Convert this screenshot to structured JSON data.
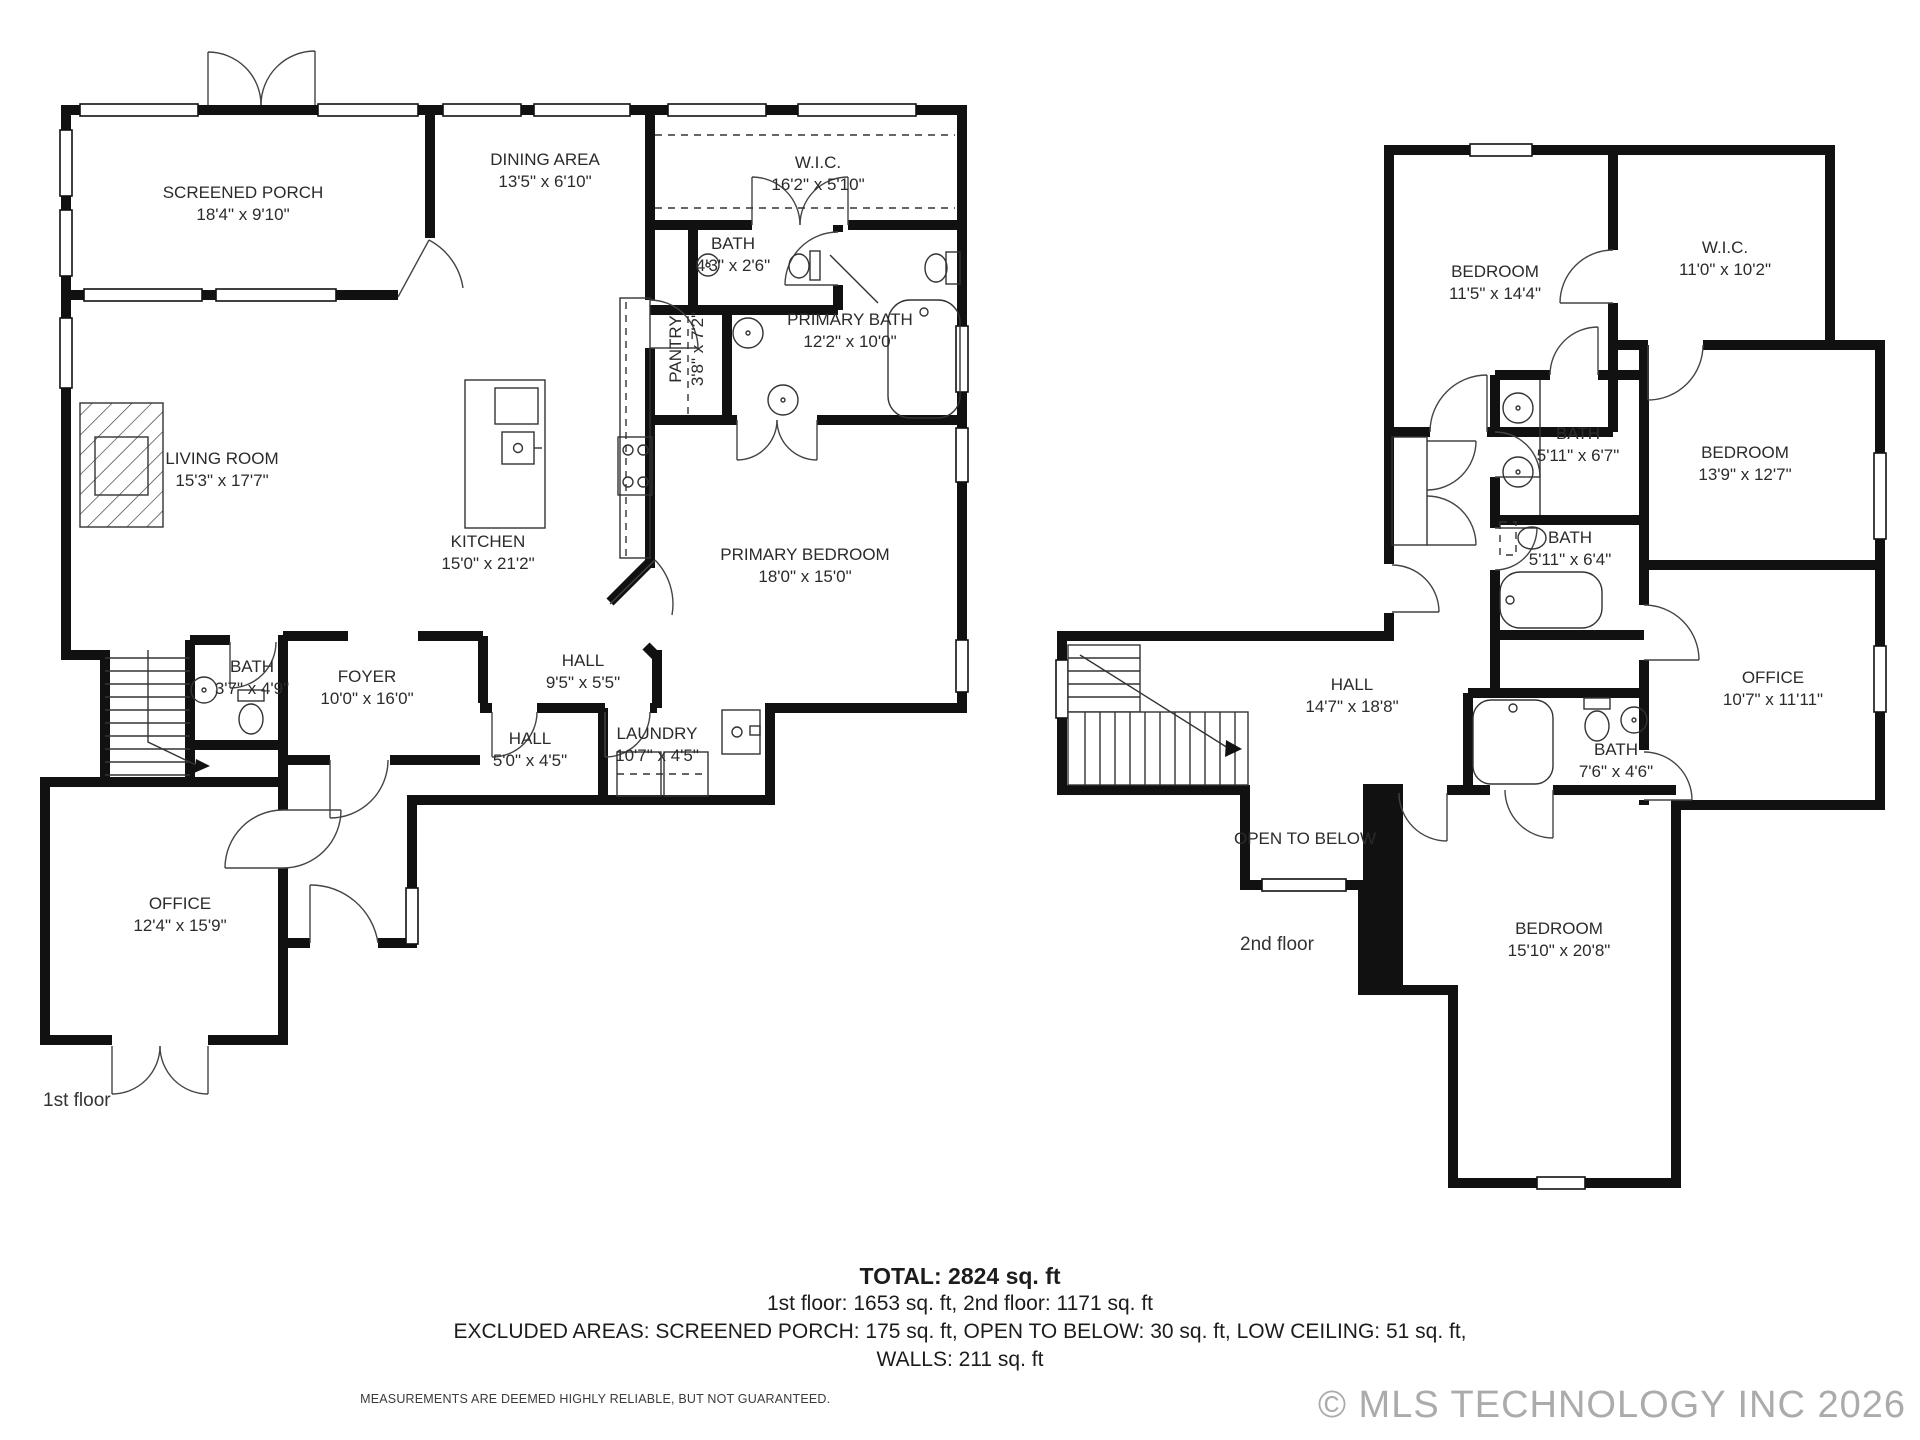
{
  "floor1": {
    "caption": "1st floor",
    "rooms": {
      "screened_porch": {
        "name": "SCREENED PORCH",
        "dims": "18'4\" x 9'10\""
      },
      "dining": {
        "name": "DINING AREA",
        "dims": "13'5\" x 6'10\""
      },
      "wic": {
        "name": "W.I.C.",
        "dims": "16'2\" x 5'10\""
      },
      "bath_small": {
        "name": "BATH",
        "dims": "4'3\" x 2'6\""
      },
      "pantry": {
        "name": "PANTRY",
        "dims": "3'8\" x 7'2\""
      },
      "primary_bath": {
        "name": "PRIMARY BATH",
        "dims": "12'2\" x 10'0\""
      },
      "living": {
        "name": "LIVING ROOM",
        "dims": "15'3\" x 17'7\""
      },
      "kitchen": {
        "name": "KITCHEN",
        "dims": "15'0\" x 21'2\""
      },
      "primary_bedroom": {
        "name": "PRIMARY BEDROOM",
        "dims": "18'0\" x 15'0\""
      },
      "hall_a": {
        "name": "HALL",
        "dims": "9'5\" x 5'5\""
      },
      "foyer": {
        "name": "FOYER",
        "dims": "10'0\" x 16'0\""
      },
      "bath": {
        "name": "BATH",
        "dims": "3'7\" x 4'9\""
      },
      "hall_b": {
        "name": "HALL",
        "dims": "5'0\" x 4'5\""
      },
      "laundry": {
        "name": "LAUNDRY",
        "dims": "10'7\" x 4'5\""
      },
      "office": {
        "name": "OFFICE",
        "dims": "12'4\" x 15'9\""
      }
    }
  },
  "floor2": {
    "caption": "2nd floor",
    "rooms": {
      "bedroom_a": {
        "name": "BEDROOM",
        "dims": "11'5\" x 14'4\""
      },
      "wic": {
        "name": "W.I.C.",
        "dims": "11'0\" x 10'2\""
      },
      "bath_a": {
        "name": "BATH",
        "dims": "5'11\" x 6'7\""
      },
      "bedroom_b": {
        "name": "BEDROOM",
        "dims": "13'9\" x 12'7\""
      },
      "bath_b": {
        "name": "BATH",
        "dims": "5'11\" x 6'4\""
      },
      "office": {
        "name": "OFFICE",
        "dims": "10'7\" x 11'11\""
      },
      "hall": {
        "name": "HALL",
        "dims": "14'7\" x 18'8\""
      },
      "bath_c": {
        "name": "BATH",
        "dims": "7'6\" x 4'6\""
      },
      "open_to_below": {
        "name": "OPEN TO BELOW"
      },
      "bedroom_c": {
        "name": "BEDROOM",
        "dims": "15'10\" x 20'8\""
      }
    }
  },
  "summary": {
    "total": "TOTAL: 2824 sq. ft",
    "floors_line": "1st floor: 1653 sq. ft, 2nd floor: 1171 sq. ft",
    "excluded_line": "EXCLUDED AREAS: SCREENED PORCH: 175 sq. ft, OPEN TO BELOW: 30 sq. ft, LOW CEILING: 51 sq. ft,",
    "walls_line": "WALLS: 211 sq. ft",
    "disclaimer": "MEASUREMENTS ARE DEEMED HIGHLY RELIABLE, BUT NOT GUARANTEED."
  },
  "watermark": "© MLS TECHNOLOGY INC 2026"
}
